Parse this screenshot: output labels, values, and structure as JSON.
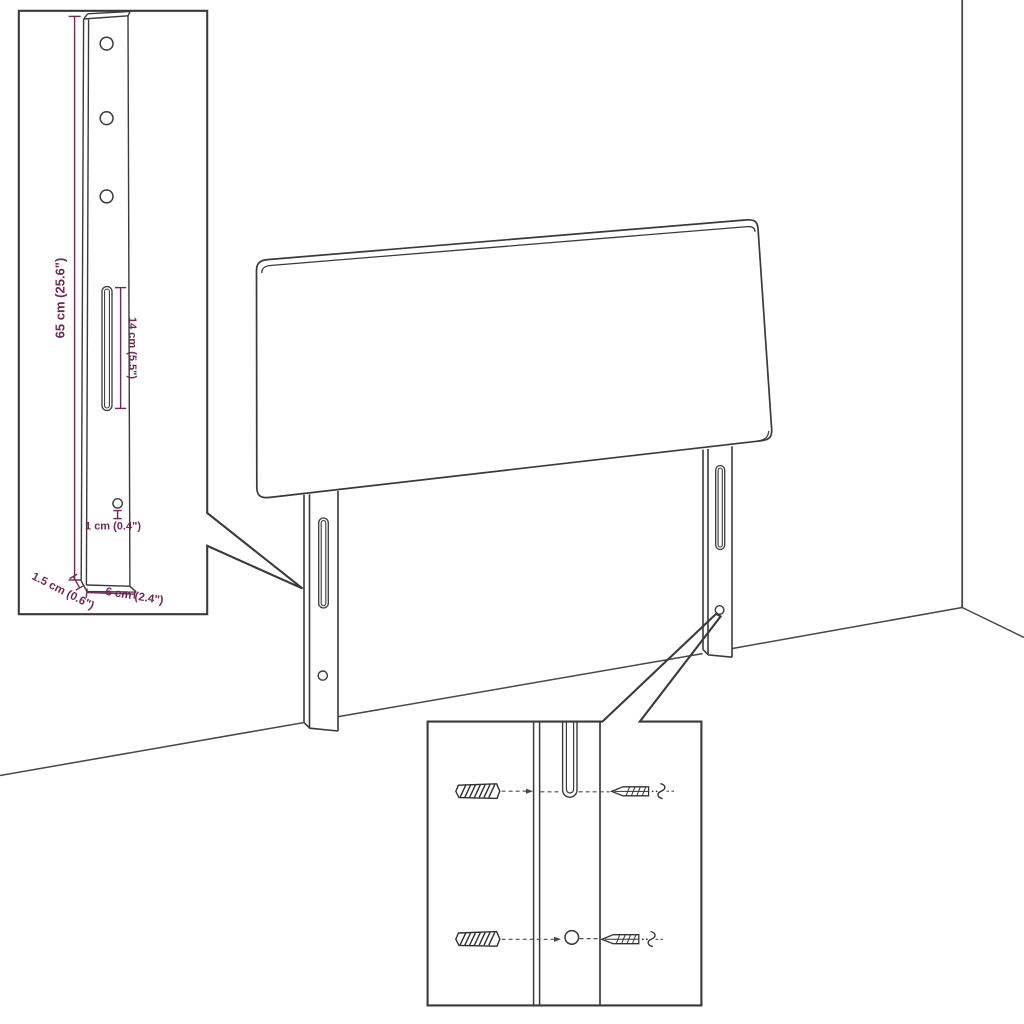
{
  "colors": {
    "line": "#3a3a3a",
    "dimension": "#6e2a55",
    "background": "#ffffff"
  },
  "bracket_inset": {
    "height_label": "65 cm (25.6\")",
    "slot_label": "14 cm (5.5\")",
    "hole_label": "1 cm (0.4\")",
    "thickness_label": "1.5 cm (0.6\")",
    "width_label": "6 cm (2.4\")"
  }
}
